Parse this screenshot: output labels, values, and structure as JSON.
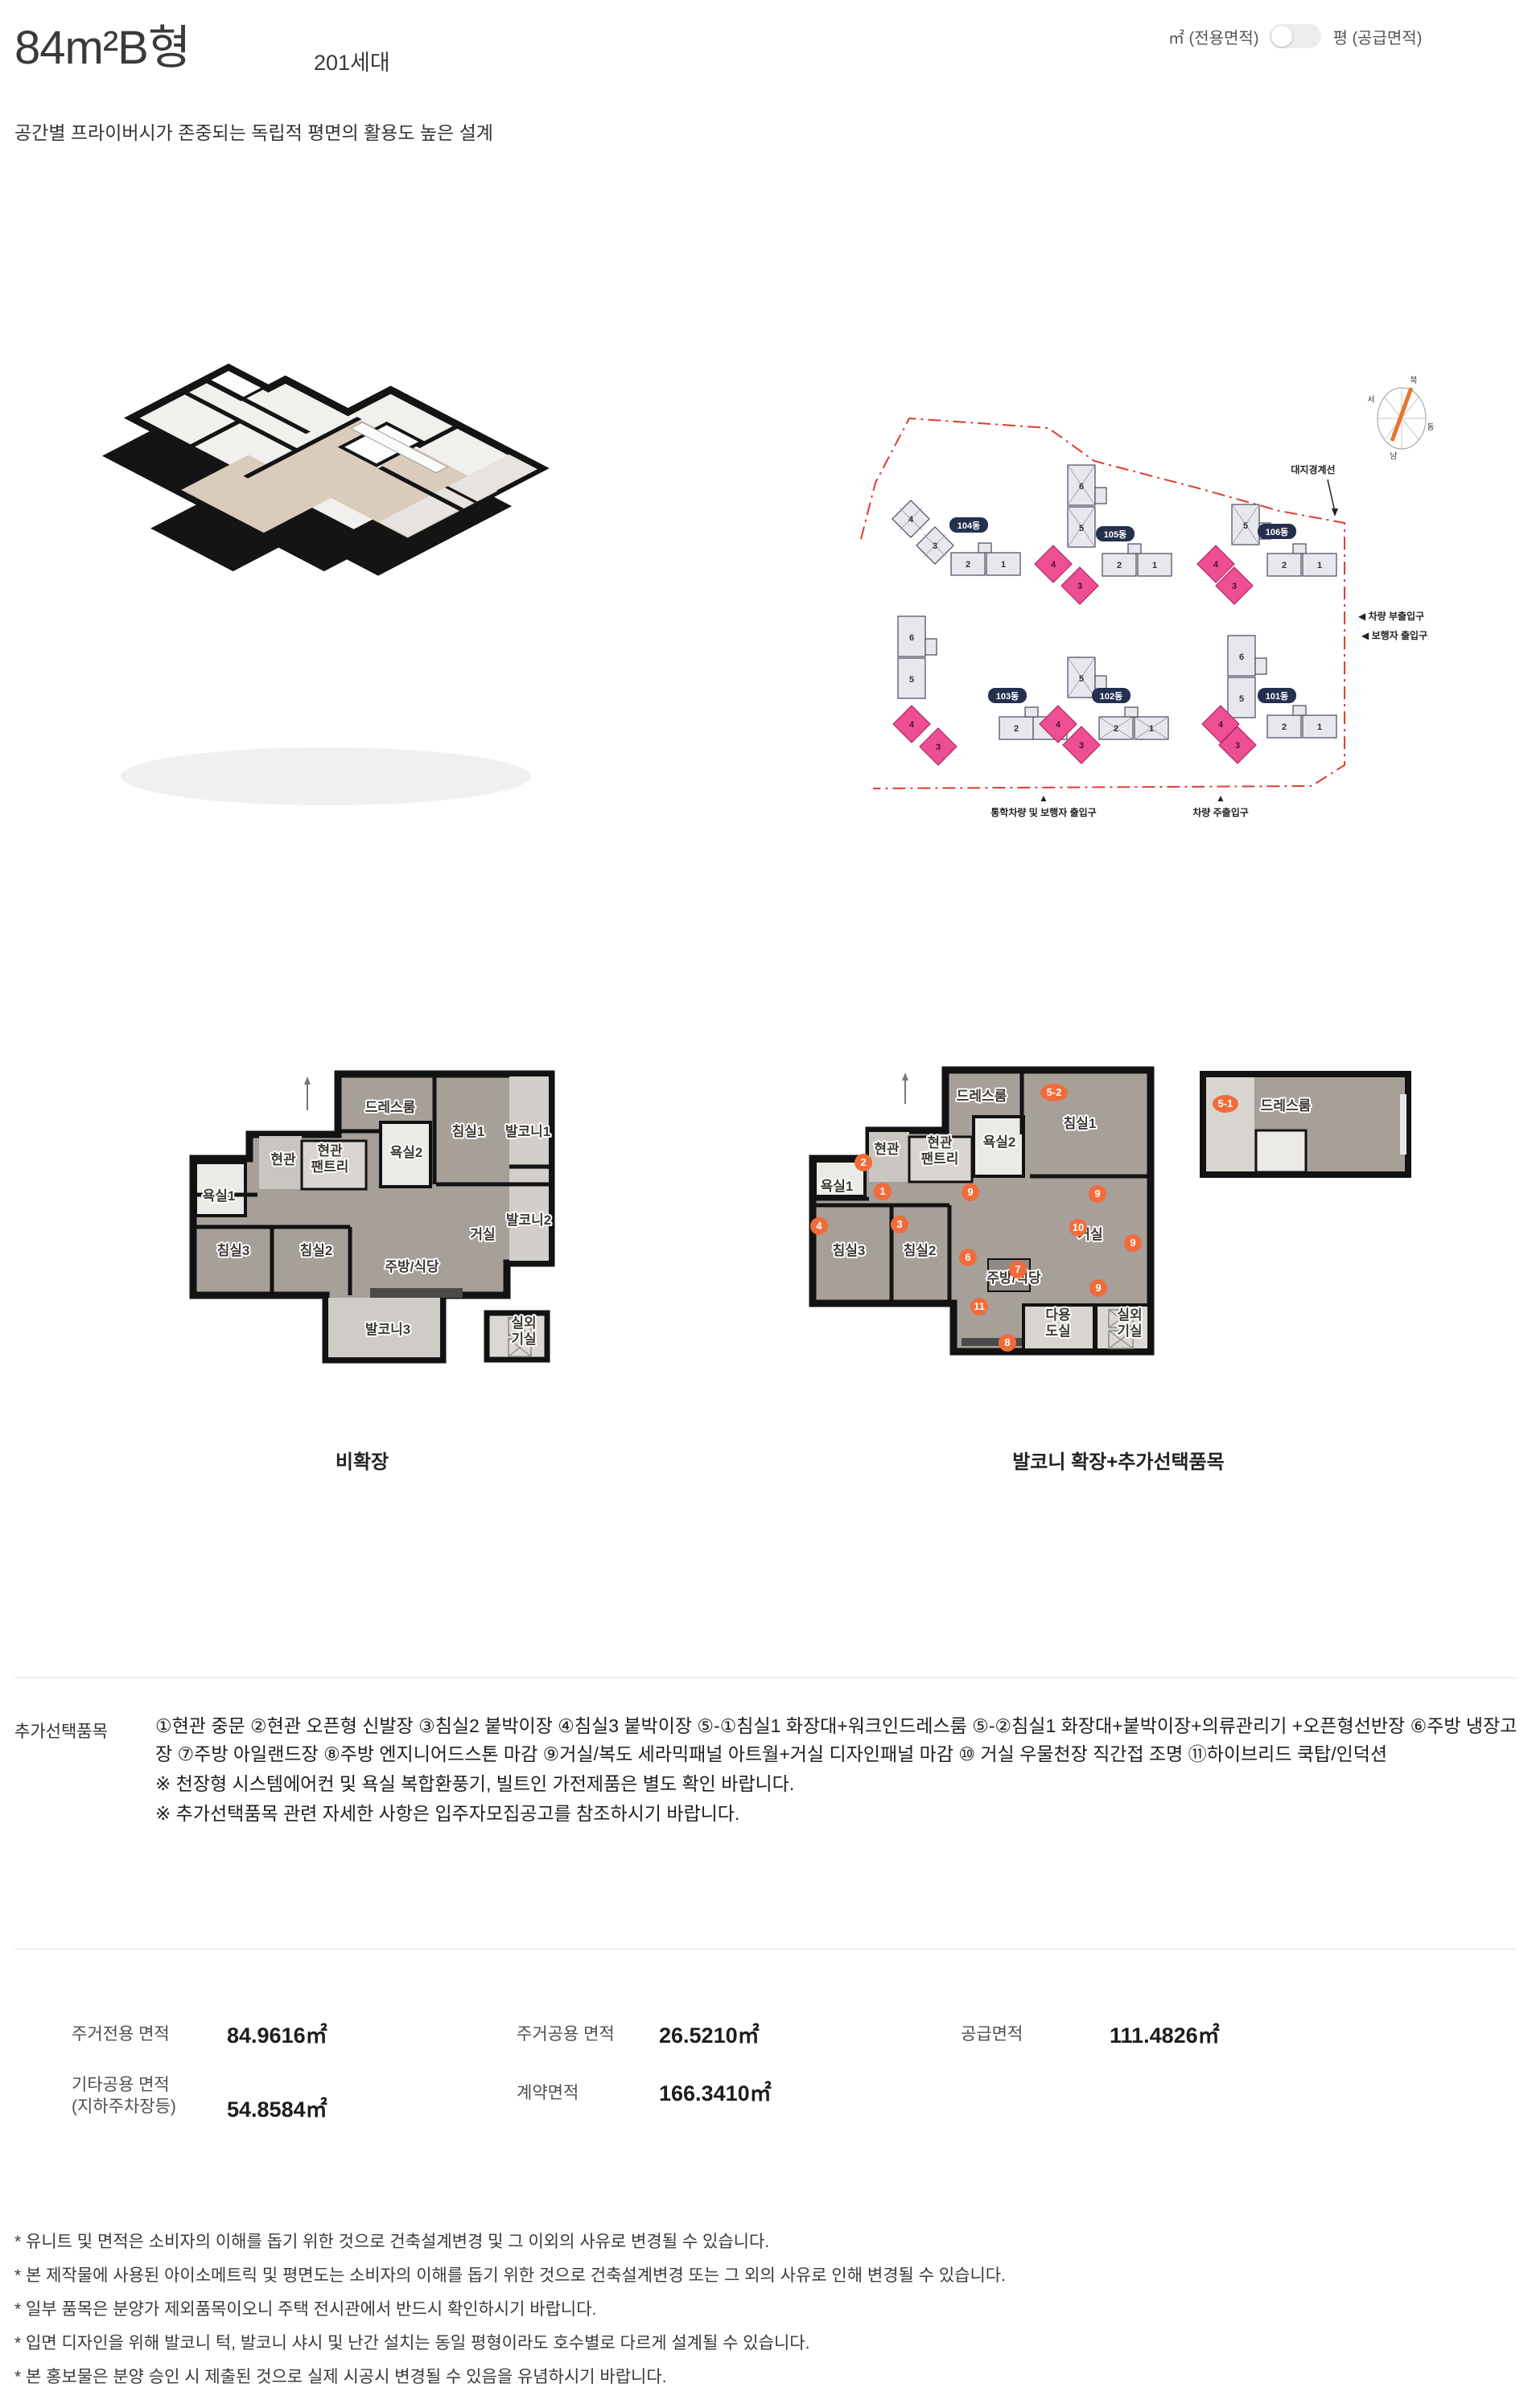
{
  "header": {
    "title": "84m²B형",
    "units_count": "201세대",
    "unit_toggle_left": "㎡ (전용면적)",
    "unit_toggle_right": "평 (공급면적)",
    "subtitle": "공간별 프라이버시가 존중되는 독립적 평면의 활용도 높은 설계"
  },
  "site_plan": {
    "boundary_label": "대지경계선",
    "compass": {
      "north": "북",
      "west": "서",
      "east": "동",
      "south": "남"
    },
    "entrance_labels": {
      "car_sub": "◀ 차량 부출입구",
      "pedestrian": "◀ 보행자 출입구",
      "school_walk_marker": "▲",
      "school_walk": "통학차량 및 보행자 출입구",
      "car_main_marker": "▲",
      "car_main": "차량 주출입구"
    },
    "buildings": [
      {
        "name": "104동",
        "units": [
          "4",
          "3",
          "2",
          "1"
        ],
        "highlighted": false
      },
      {
        "name": "105동",
        "units": [
          "6",
          "5",
          "4",
          "3",
          "2",
          "1"
        ],
        "highlighted": true
      },
      {
        "name": "106동",
        "units": [
          "5",
          "4",
          "3",
          "2",
          "1"
        ],
        "highlighted": true
      },
      {
        "name": "103동",
        "units": [
          "6",
          "5",
          "4",
          "3",
          "2",
          "1"
        ],
        "highlighted": true
      },
      {
        "name": "102동",
        "units": [
          "5",
          "4",
          "3",
          "2",
          "1"
        ],
        "highlighted": true
      },
      {
        "name": "101동",
        "units": [
          "6",
          "5",
          "4",
          "3",
          "2",
          "1"
        ],
        "highlighted": true
      }
    ],
    "highlight_color": "#ee4f92",
    "boundary_color": "#e03c31"
  },
  "floor_plans": {
    "left": {
      "caption": "비확장",
      "rooms": [
        "드레스룸",
        "침실1",
        "발코니1",
        "욕실2",
        "현관",
        "현관\n팬트리",
        "욕실1",
        "침실3",
        "침실2",
        "거실",
        "발코니2",
        "주방/식당",
        "발코니3",
        "실외\n기실"
      ]
    },
    "right": {
      "caption": "발코니 확장+추가선택품목",
      "rooms": [
        "드레스룸",
        "침실1",
        "욕실2",
        "현관",
        "현관\n팬트리",
        "욕실1",
        "침실3",
        "침실2",
        "거실",
        "주방/식당",
        "다용\n도실",
        "실외\n기실"
      ],
      "badges": [
        "5-2",
        "2",
        "1",
        "9",
        "9",
        "4",
        "3",
        "10",
        "9",
        "6",
        "7",
        "9",
        "11",
        "8"
      ],
      "fragment": {
        "badge": "5-1",
        "label": "드레스룸"
      },
      "badge_color": "#f26b3a"
    }
  },
  "options": {
    "label": "추가선택품목",
    "items_text": "①현관 중문 ②현관 오픈형 신발장 ③침실2 붙박이장 ④침실3 붙박이장 ⑤-①침실1 화장대+워크인드레스룸 ⑤-②침실1 화장대+붙박이장+의류관리기 +오픈형선반장 ⑥주방 냉장고장 ⑦주방 아일랜드장 ⑧주방 엔지니어드스톤 마감 ⑨거실/복도 세라믹패널 아트월+거실 디자인패널 마감 ⑩ 거실 우물천장 직간접 조명 ⑪하이브리드 쿡탑/인덕션",
    "notes": [
      "※ 천장형 시스템에어컨 및 욕실 복합환풍기, 빌트인 가전제품은 별도 확인 바랍니다.",
      "※ 추가선택품목 관련 자세한 사항은 입주자모집공고를 참조하시기 바랍니다."
    ]
  },
  "areas": {
    "items": [
      {
        "label": "주거전용 면적",
        "label2": "",
        "value": "84.9616㎡"
      },
      {
        "label": "주거공용 면적",
        "label2": "",
        "value": "26.5210㎡"
      },
      {
        "label": "공급면적",
        "label2": "",
        "value": "111.4826㎡"
      },
      {
        "label": "기타공용 면적",
        "label2": "(지하주차장등)",
        "value": "54.8584㎡"
      },
      {
        "label": "계약면적",
        "label2": "",
        "value": "166.3410㎡"
      }
    ]
  },
  "footnotes": [
    "* 유니트 및 면적은 소비자의 이해를 돕기 위한 것으로 건축설계변경 및 그 이외의 사유로 변경될 수 있습니다.",
    "* 본 제작물에 사용된 아이소메트릭 및 평면도는 소비자의 이해를 돕기 위한 것으로 건축설계변경 또는 그 외의 사유로 인해 변경될 수 있습니다.",
    "* 일부 품목은 분양가 제외품목이오니 주택 전시관에서 반드시 확인하시기 바랍니다.",
    "* 입면 디자인을 위해 발코니 턱, 발코니 샤시 및 난간 설치는 동일 평형이라도 호수별로 다르게 설계될 수 있습니다.",
    "* 본 홍보물은 분양 승인 시 제출된 것으로 실제 시공시 변경될 수 있음을 유념하시기 바랍니다."
  ]
}
